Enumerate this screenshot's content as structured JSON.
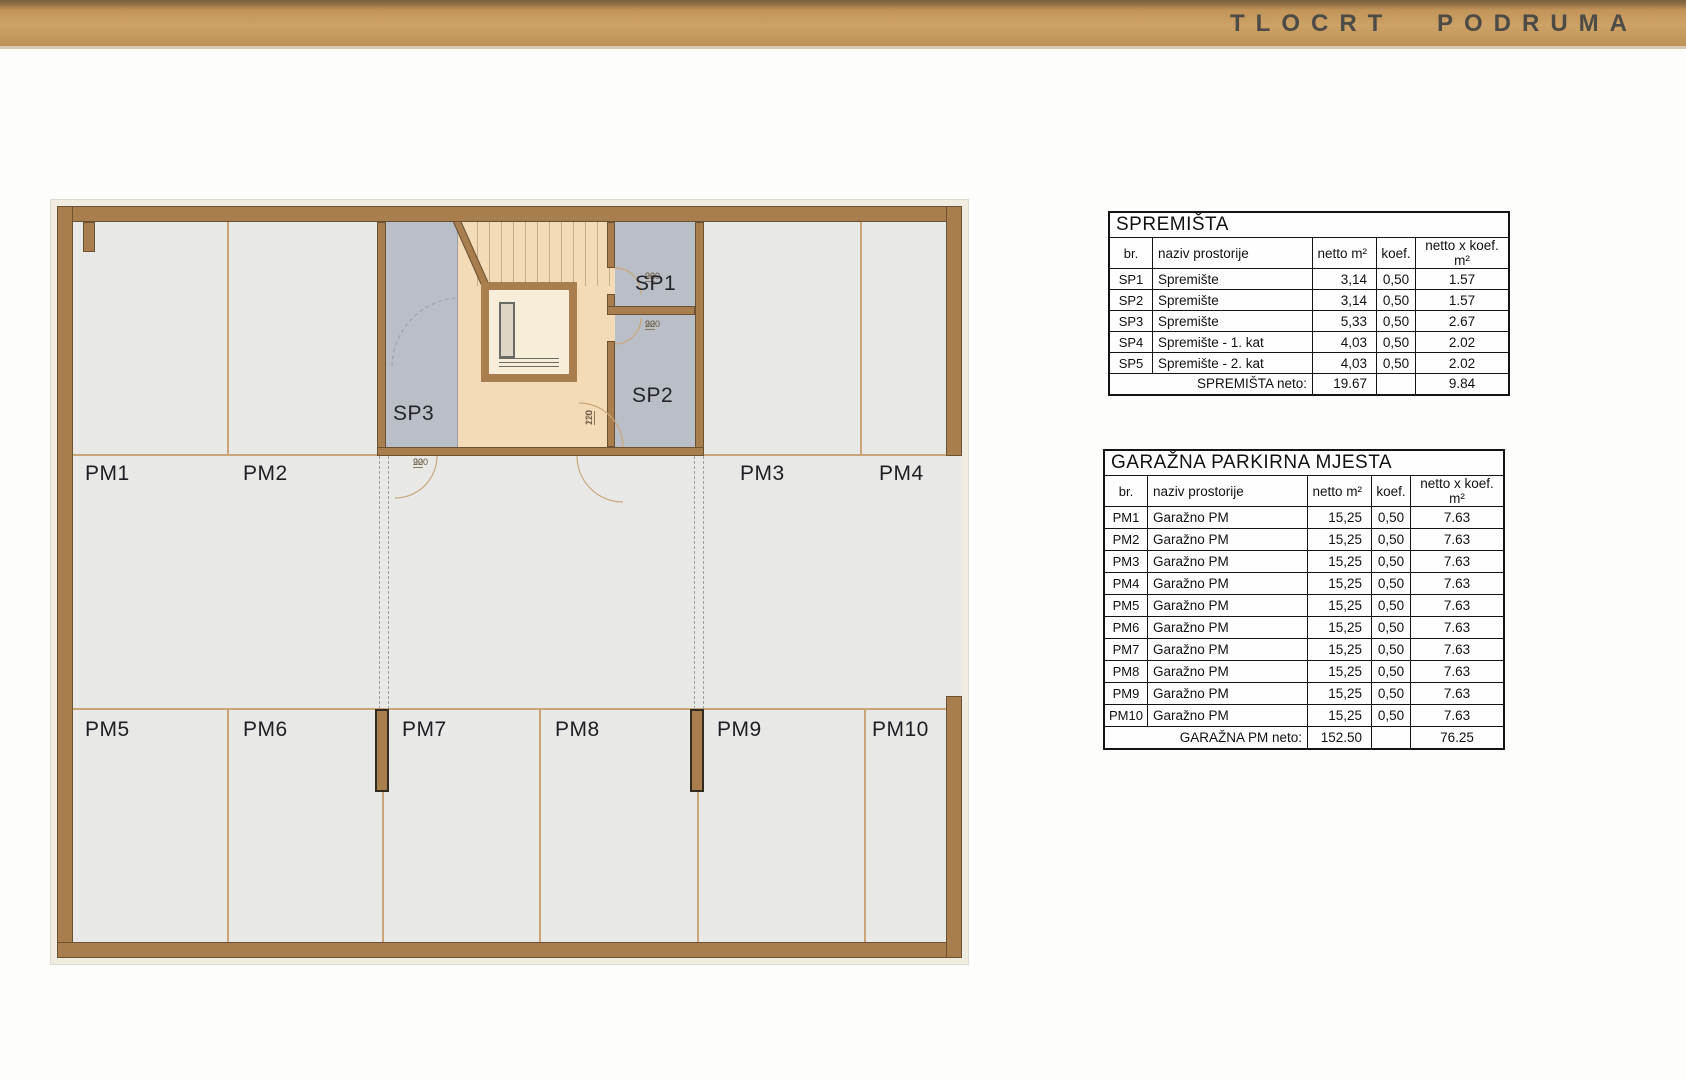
{
  "header": {
    "title": "TLOCRT PODRUMA"
  },
  "colors": {
    "banner_tan": "#c59b64",
    "wall_brown": "#a87e4f",
    "floor_gray": "#e8e8e7",
    "storage_gray": "#b9bec7",
    "corridor_beige": "#f4dbb8",
    "stall_line_tan": "#c8a67a"
  },
  "plan": {
    "labels": {
      "pm1": "PM1",
      "pm2": "PM2",
      "pm3": "PM3",
      "pm4": "PM4",
      "pm5": "PM5",
      "pm6": "PM6",
      "pm7": "PM7",
      "pm8": "PM8",
      "pm9": "PM9",
      "pm10": "PM10",
      "sp1": "SP1",
      "sp2": "SP2",
      "sp3": "SP3"
    },
    "doors": [
      {
        "num": "90",
        "den": "220"
      },
      {
        "num": "90",
        "den": "220"
      },
      {
        "num": "90",
        "den": "220"
      },
      {
        "num": "110",
        "den": "220"
      }
    ]
  },
  "tables": {
    "spremista": {
      "title": "SPREMIŠTA",
      "headers": [
        "br.",
        "naziv prostorije",
        "netto m²",
        "koef.",
        "netto x koef. m²"
      ],
      "rows": [
        [
          "SP1",
          "Spremište",
          "3,14",
          "0,50",
          "1.57"
        ],
        [
          "SP2",
          "Spremište",
          "3,14",
          "0,50",
          "1.57"
        ],
        [
          "SP3",
          "Spremište",
          "5,33",
          "0,50",
          "2.67"
        ],
        [
          "SP4",
          "Spremište - 1. kat",
          "4,03",
          "0,50",
          "2.02"
        ],
        [
          "SP5",
          "Spremište - 2. kat",
          "4,03",
          "0,50",
          "2.02"
        ]
      ],
      "total_label": "SPREMIŠTA neto:",
      "total_netto": "19.67",
      "total_koef": "",
      "total_product": "9.84"
    },
    "garazna": {
      "title": "GARAŽNA PARKIRNA MJESTA",
      "headers": [
        "br.",
        "naziv prostorije",
        "netto m²",
        "koef.",
        "netto x koef. m²"
      ],
      "rows": [
        [
          "PM1",
          "Garažno PM",
          "15,25",
          "0,50",
          "7.63"
        ],
        [
          "PM2",
          "Garažno PM",
          "15,25",
          "0,50",
          "7.63"
        ],
        [
          "PM3",
          "Garažno PM",
          "15,25",
          "0,50",
          "7.63"
        ],
        [
          "PM4",
          "Garažno PM",
          "15,25",
          "0,50",
          "7.63"
        ],
        [
          "PM5",
          "Garažno PM",
          "15,25",
          "0,50",
          "7.63"
        ],
        [
          "PM6",
          "Garažno PM",
          "15,25",
          "0,50",
          "7.63"
        ],
        [
          "PM7",
          "Garažno PM",
          "15,25",
          "0,50",
          "7.63"
        ],
        [
          "PM8",
          "Garažno PM",
          "15,25",
          "0,50",
          "7.63"
        ],
        [
          "PM9",
          "Garažno PM",
          "15,25",
          "0,50",
          "7.63"
        ],
        [
          "PM10",
          "Garažno PM",
          "15,25",
          "0,50",
          "7.63"
        ]
      ],
      "total_label": "GARAŽNA PM neto:",
      "total_netto": "152.50",
      "total_koef": "",
      "total_product": "76.25"
    }
  }
}
